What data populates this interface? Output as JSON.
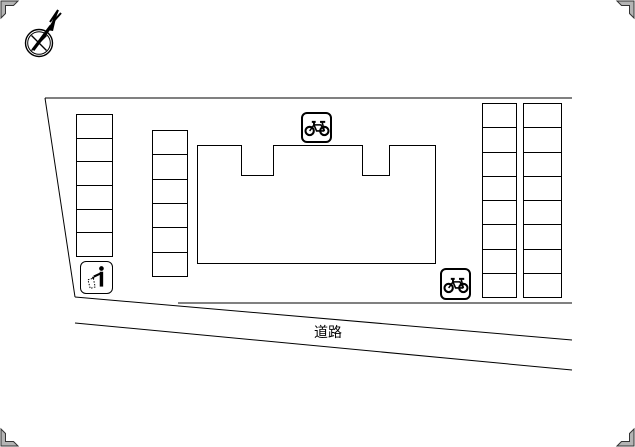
{
  "plan": {
    "background_color": "#ffffff",
    "line_color": "#000000",
    "corner_mark_color": "#b4b4b4",
    "road": {
      "label": "道路"
    },
    "parking_lots": [
      {
        "id": "left",
        "spaces": 6
      },
      {
        "id": "middle",
        "spaces": 6
      },
      {
        "id": "right-inner",
        "spaces": 8
      },
      {
        "id": "right-outer",
        "spaces": 8
      }
    ],
    "building": {
      "notch_count": 2
    },
    "markers": {
      "bicycle_parking_count": 2,
      "garbage_station_count": 1,
      "north_arrow_count": 1
    }
  }
}
